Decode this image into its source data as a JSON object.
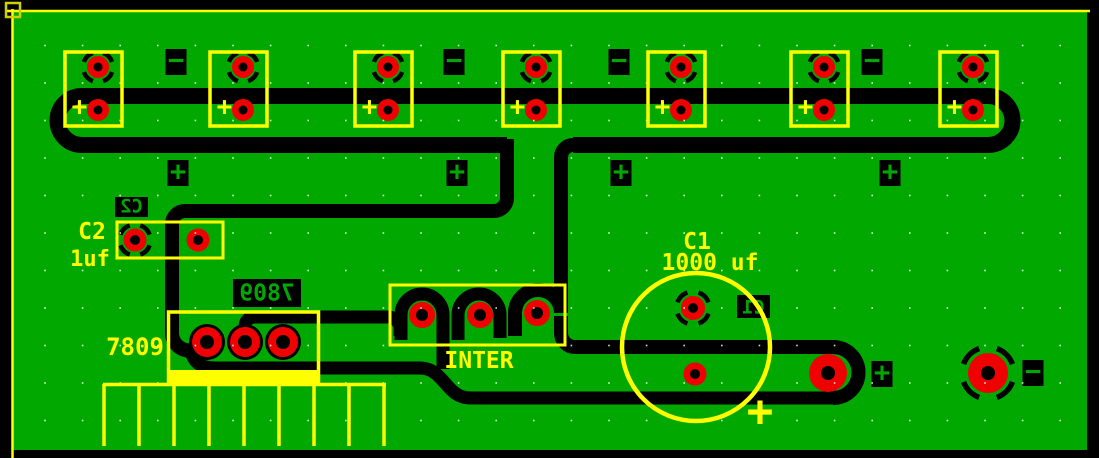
{
  "window": {
    "description": "PCB layout editor canvas",
    "canvas_width": 1099,
    "canvas_height": 458
  },
  "colors": {
    "background": "#000000",
    "board_green": "#00A800",
    "copper_black": "#000000",
    "pad_red": "#F00000",
    "silkscreen_yellow": "#FFFF00",
    "corner_marker_yellow": "#D0D000",
    "copper_text_green": "#00A800",
    "grid_dot": "#FFFFFF"
  },
  "labels": {
    "c2_ref": "C2",
    "c2_value": "1uf",
    "regulator_value": "7809",
    "connector_name": "INTER",
    "c1_ref": "C1",
    "c1_value": "1000 uf",
    "c1_polarity": "+",
    "battery_plus": "+",
    "mirrored_c2": "C2",
    "mirrored_7809": "7809",
    "mirrored_c1": "C1",
    "plus_glyph": "+",
    "minus_glyph": "−"
  },
  "battery_clips": {
    "count": 7,
    "xs": [
      65,
      210,
      355,
      503,
      648,
      791,
      940
    ],
    "width": 57,
    "top": 52,
    "height": 74,
    "pad_offset_x": 33,
    "top_pad_y": 67,
    "bottom_pad_y": 110,
    "pad_radius": 11,
    "hole_radius": 4.5,
    "thermal_radius": 15
  },
  "polarity_squares": {
    "minus_top": [
      {
        "cx": 176,
        "cy": 62
      },
      {
        "cx": 454,
        "cy": 62
      },
      {
        "cx": 619,
        "cy": 62
      },
      {
        "cx": 872,
        "cy": 62
      }
    ],
    "plus_mid": [
      {
        "cx": 178,
        "cy": 173
      },
      {
        "cx": 457,
        "cy": 173
      },
      {
        "cx": 621,
        "cy": 173
      },
      {
        "cx": 890,
        "cy": 173
      }
    ],
    "plus_bottom": [
      {
        "cx": 882,
        "cy": 374
      }
    ],
    "minus_bottom": [
      {
        "cx": 1033,
        "cy": 373
      }
    ]
  },
  "pads": {
    "c2": [
      {
        "cx": 135,
        "cy": 240,
        "r": 11.5,
        "hole": 5,
        "thermal": true,
        "thermal_r": 15.5
      },
      {
        "cx": 198,
        "cy": 240,
        "r": 11.5,
        "hole": 5
      }
    ],
    "regulator": [
      {
        "cx": 207,
        "cy": 342,
        "r": 15,
        "hole": 7,
        "blob": 18
      },
      {
        "cx": 245,
        "cy": 342,
        "r": 15,
        "hole": 7,
        "blob": 18
      },
      {
        "cx": 283,
        "cy": 342,
        "r": 15,
        "hole": 7,
        "blob": 18
      }
    ],
    "inter": [
      {
        "cx": 422,
        "cy": 315,
        "r": 13,
        "hole": 6
      },
      {
        "cx": 480,
        "cy": 315,
        "r": 13,
        "hole": 6
      },
      {
        "cx": 537,
        "cy": 313,
        "r": 13,
        "hole": 6
      }
    ],
    "c1": [
      {
        "cx": 693,
        "cy": 308,
        "r": 12,
        "hole": 5,
        "thermal": true,
        "thermal_r": 16.5
      },
      {
        "cx": 695,
        "cy": 374,
        "r": 11.5,
        "hole": 5
      }
    ],
    "power_out": {
      "cx": 828,
      "cy": 373,
      "r": 19,
      "hole": 7
    },
    "ground": {
      "cx": 988,
      "cy": 373,
      "r": 20,
      "hole": 7,
      "thermal": true,
      "thermal_r": 26,
      "thermal_sw": 5.5
    }
  },
  "heatsink_fins": {
    "x_start": 104,
    "step": 35,
    "count": 9,
    "y_top": 384,
    "y_bottom": 446
  },
  "grid": {
    "x_start": 45,
    "x_step": 37.6,
    "y_start": 45.5,
    "y_step": 37.5
  }
}
